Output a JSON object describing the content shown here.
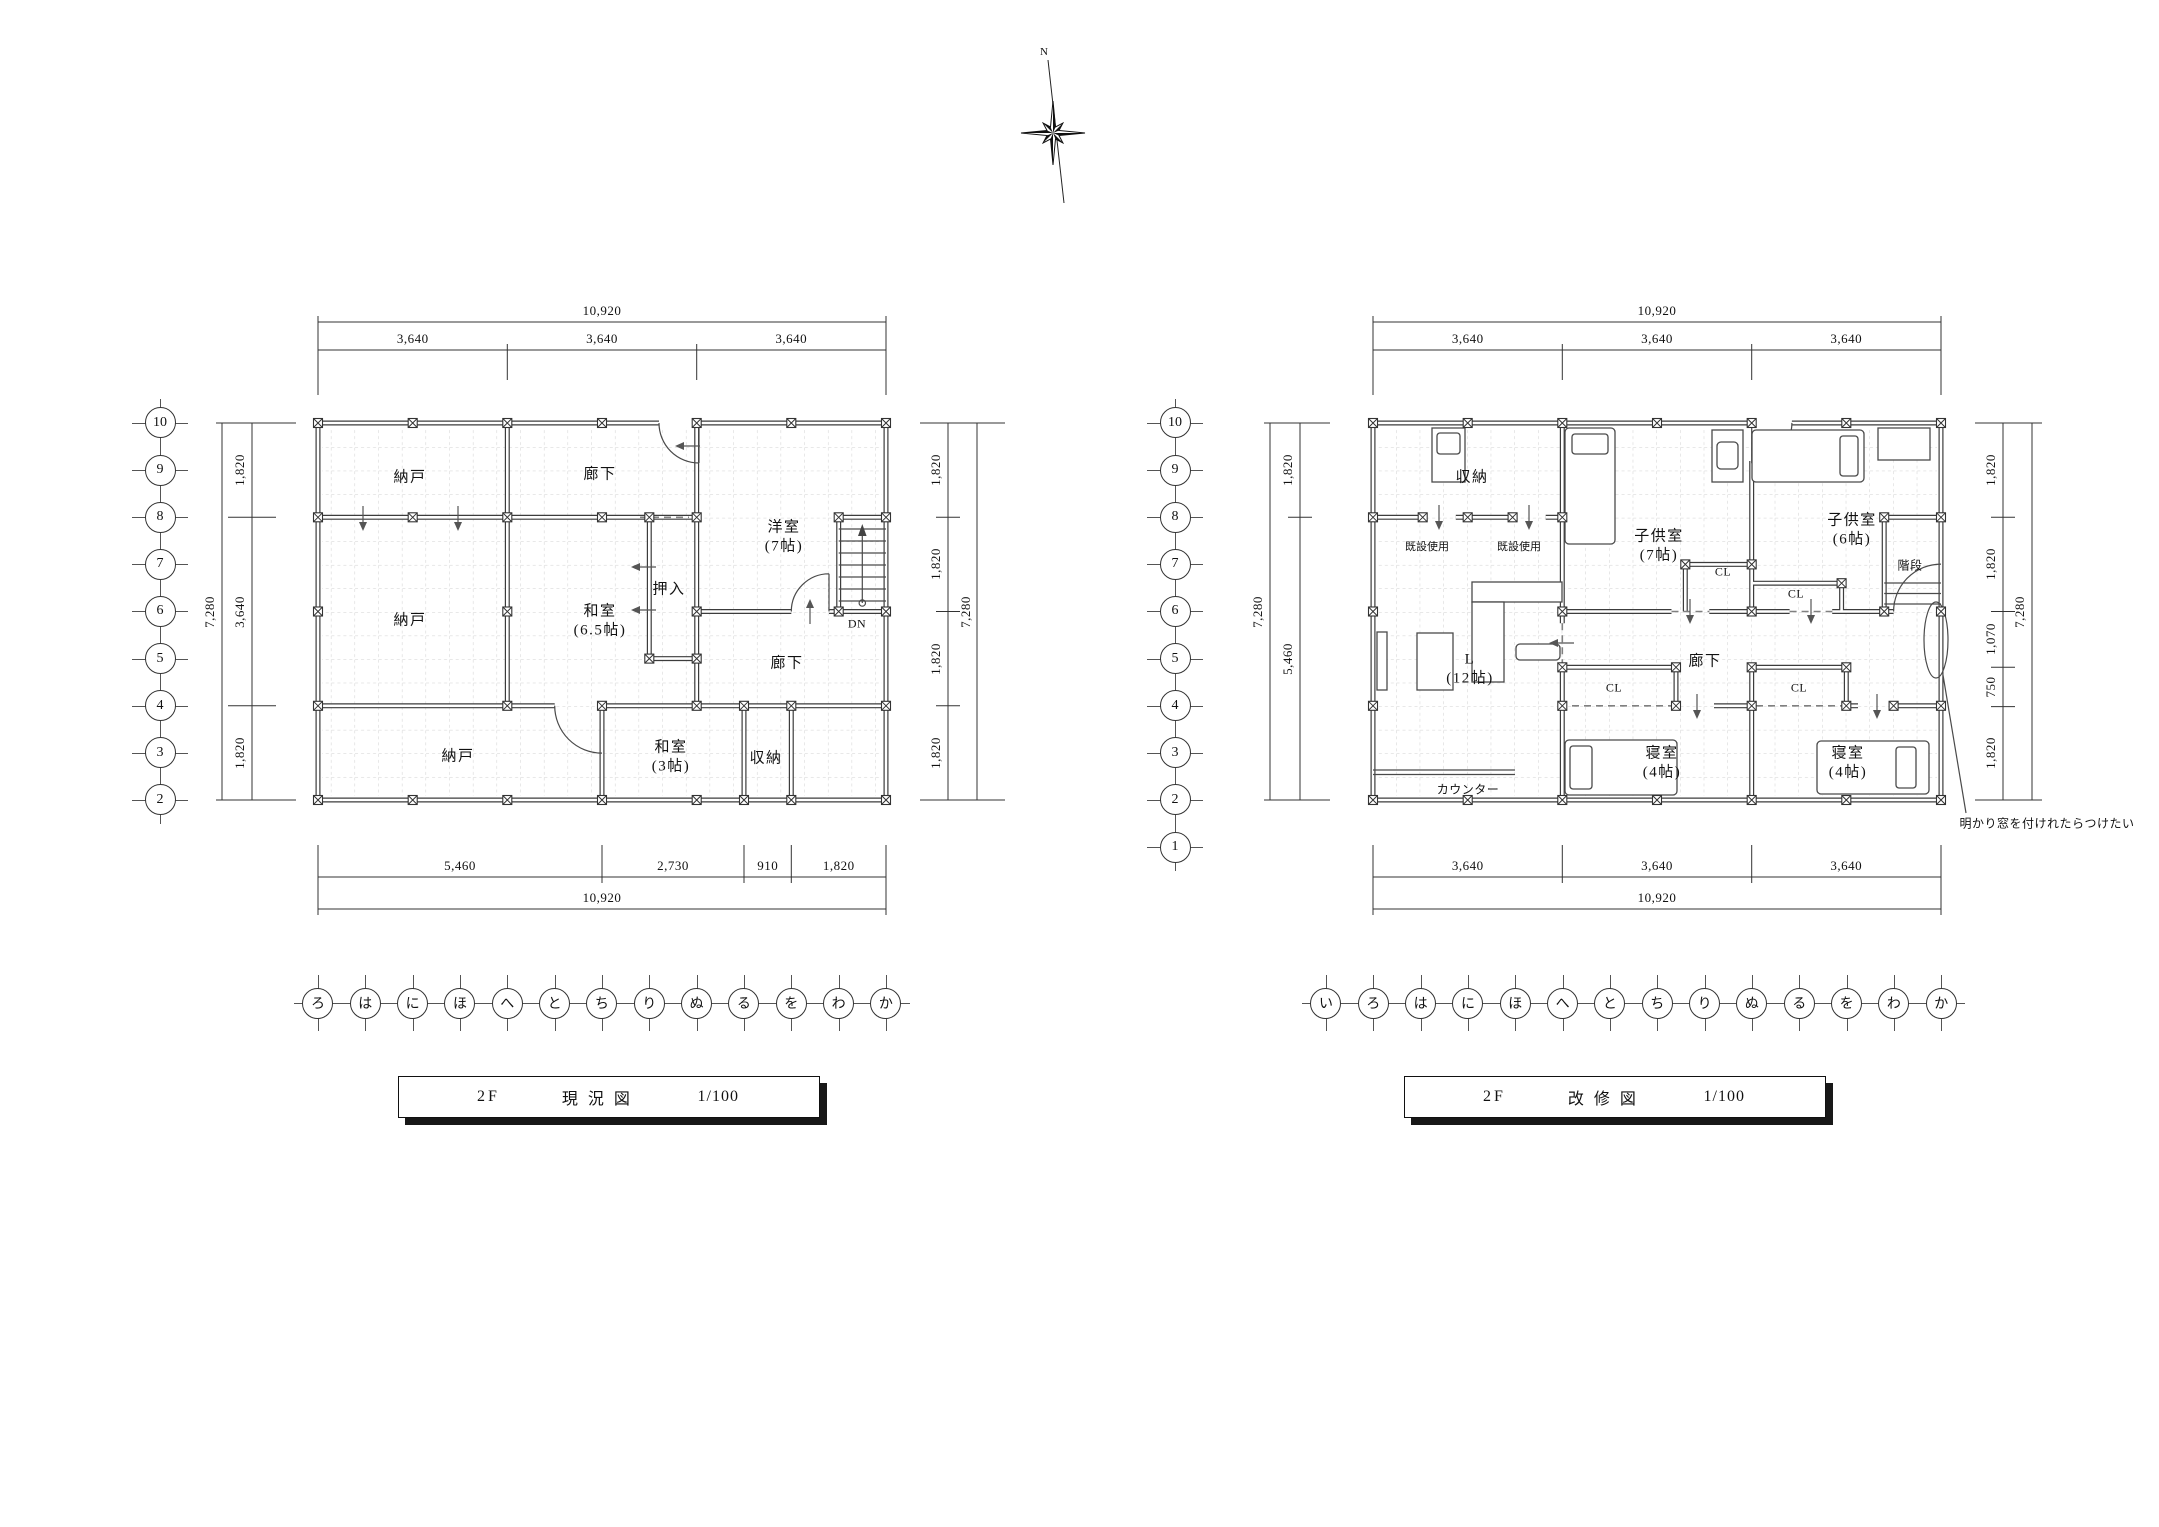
{
  "compass": {
    "north": "N"
  },
  "plans": [
    {
      "title": {
        "floor": "2F",
        "name": "現況図",
        "scale": "1/100"
      },
      "dims": {
        "top": {
          "overall": "10,920",
          "segs": [
            "3,640",
            "3,640",
            "3,640"
          ]
        },
        "bottom": {
          "overall": "10,920",
          "segs": [
            "5,460",
            "2,730",
            "910",
            "1,820"
          ]
        },
        "left": {
          "overall": "7,280",
          "segs": [
            "1,820",
            "3,640",
            "1,820"
          ]
        },
        "right": {
          "overall": "7,280",
          "segs": [
            "1,820",
            "1,820",
            "1,820",
            "1,820"
          ]
        }
      },
      "grid_rows": [
        "10",
        "9",
        "8",
        "7",
        "6",
        "5",
        "4",
        "3",
        "2"
      ],
      "grid_cols": [
        "ろ",
        "は",
        "に",
        "ほ",
        "へ",
        "と",
        "ち",
        "り",
        "ぬ",
        "る",
        "を",
        "わ",
        "か"
      ],
      "labels": {
        "nando_top": "納戸",
        "rouka_top": "廊下",
        "yoshitsu": "洋室",
        "yoshitsu_size": "(7帖)",
        "oshiire": "押入",
        "nando_mid": "納戸",
        "washitsu65": "和室",
        "washitsu65_size": "(6.5帖)",
        "rouka_low": "廊下",
        "dn": "DN",
        "nando_btm": "納戸",
        "washitsu3": "和室",
        "washitsu3_size": "(3帖)",
        "shuno": "収納"
      }
    },
    {
      "title": {
        "floor": "2F",
        "name": "改修図",
        "scale": "1/100"
      },
      "dims": {
        "top": {
          "overall": "10,920",
          "segs": [
            "3,640",
            "3,640",
            "3,640"
          ]
        },
        "bottom": {
          "overall": "10,920",
          "segs": [
            "3,640",
            "3,640",
            "3,640"
          ]
        },
        "left": {
          "overall": "7,280",
          "segs": [
            "1,820",
            "5,460"
          ]
        },
        "right": {
          "overall": "7,280",
          "segs": [
            "1,820",
            "1,820",
            "1,070",
            "750",
            "1,820"
          ]
        }
      },
      "grid_rows": [
        "10",
        "9",
        "8",
        "7",
        "6",
        "5",
        "4",
        "3",
        "2",
        "1"
      ],
      "grid_cols": [
        "い",
        "ろ",
        "は",
        "に",
        "ほ",
        "へ",
        "と",
        "ち",
        "り",
        "ぬ",
        "る",
        "を",
        "わ",
        "か"
      ],
      "labels": {
        "shuno": "収納",
        "kisetsu1": "既設使用",
        "kisetsu2": "既設使用",
        "kodomo7": "子供室",
        "kodomo7_size": "(7帖)",
        "kodomo6": "子供室",
        "kodomo6_size": "(6帖)",
        "kaidan": "階段",
        "cl1": "CL",
        "cl2": "CL",
        "cl3": "CL",
        "cl4": "CL",
        "living": "L",
        "living_size": "(12帖)",
        "rouka": "廊下",
        "shinshitsu1": "寝室",
        "shinshitsu1_size": "(4帖)",
        "shinshitsu2": "寝室",
        "shinshitsu2_size": "(4帖)",
        "counter": "カウンター",
        "annotation": "明かり窓を付けれたらつけたい"
      }
    }
  ]
}
